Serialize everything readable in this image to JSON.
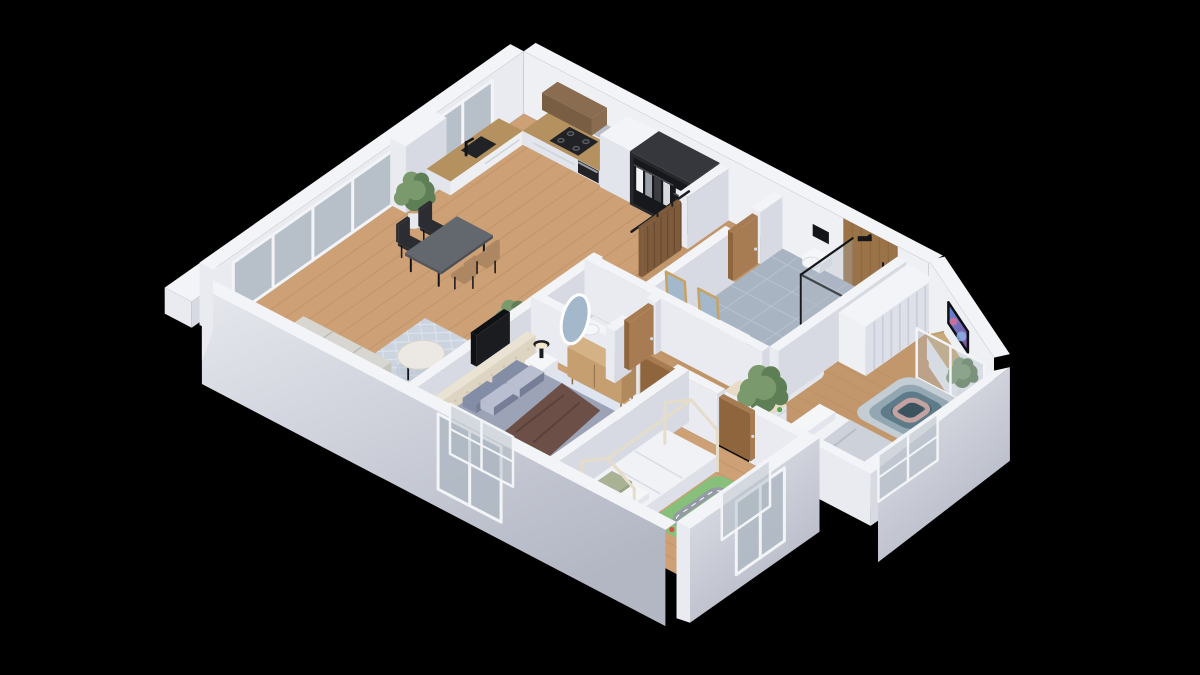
{
  "canvas": {
    "width": 1200,
    "height": 675,
    "background": "#000000"
  },
  "scene_type": "isometric-3d-apartment-floor-plan",
  "palette": {
    "bg": "#000000",
    "wall_top": "#f3f4f7",
    "wall_sw": "#e9ebf1",
    "wall_se": "#d7dae3",
    "wall_lit": "#eef0f4",
    "facade_a": "#e6e8ee",
    "facade_b": "#b3b7c4",
    "floor_wood": "#cda175",
    "floor_wood_line": "#b88d61",
    "floor_wood_dark": "#c2976b",
    "tile_bath": "#a9b4c3",
    "tile_bath_line": "#bcc6d2",
    "tile_wc": "#e8eaee",
    "glass": "#aeb8c2",
    "frame_white": "#f2f4f7",
    "rug_living": "#ccd4e0",
    "rug_living_line": "#dde3ed",
    "rug_bedroom": "#dee5f0",
    "sofa": "#d8d6d0",
    "sofa_dark": "#c6c4be",
    "marble": "#ece9e4",
    "table_dark": "#63676e",
    "chair_black": "#2b2d32",
    "chair_tan": "#ad8662",
    "counter_wood": "#b5915f",
    "cab_white": "#edeff3",
    "cab_white_face": "#e2e5ec",
    "upper_wood": "#8a6c50",
    "appliance_black": "#202226",
    "backsplash": "#b9bec8",
    "wardrobe_black": "#26282c",
    "wardrobe_inner": "#17181b",
    "door_wood": "#a87c52",
    "door_wood_dark": "#8f653d",
    "barn_wood": "#7d5b3c",
    "rail_black": "#1c1d20",
    "vanity_wood": "#b28b60",
    "white": "#f5f6f8",
    "mirror_brass": "#c6a263",
    "mirror_glass": "#a3b8ca",
    "shower_wood": "#9a7348",
    "black": "#141518",
    "tub_inner": "#dfe4ea",
    "headboard": "#eae3d3",
    "bedding_gray": "#9ca3b6",
    "bedding_side": "#b3b8c8",
    "pillow_gray": "#848da6",
    "pillow_light": "#b9bed1",
    "throw_brown": "#6c5047",
    "dresser_wood": "#c59f6f",
    "house_bed": "#e5ddca",
    "kids_bedding": "#f1f2f5",
    "pillow_sage": "#a9b295",
    "mat_green": "#87c07b",
    "mat_road": "#949ba4",
    "closet_stripe": "#c9cdd7",
    "tv_black": "#0f1013",
    "spa_r1": "#c4ccd4",
    "spa_r2": "#93a7b3",
    "spa_r3": "#5d7b88",
    "spa_r4": "#45636f",
    "spa_mauve": "#c4a2a2",
    "spa_center": "#3a535f",
    "plant_green": "#5e7f55",
    "plant_green2": "#7a9a6e",
    "pot_white": "#e8e9ec",
    "toy_colors": [
      "#d94f43",
      "#3f76c9",
      "#e8c33a",
      "#58a44f",
      "#7a52a8"
    ]
  },
  "rooms": [
    {
      "name": "living-dining-kitchen",
      "floor": "wood",
      "items": [
        "sofa",
        "area-rug",
        "coffee-table",
        "dining-table",
        "dining-chairs",
        "kitchen-counter",
        "kitchen-sink",
        "cooktop",
        "oven",
        "upper-cabinets",
        "tall-cabinet",
        "open-wardrobe",
        "floor-plants",
        "window-wall"
      ]
    },
    {
      "name": "wc",
      "floor": "tile",
      "items": [
        "toilet",
        "oval-mirror",
        "wooden-door"
      ]
    },
    {
      "name": "hallway",
      "floor": "wood",
      "items": [
        "sliding-barn-door",
        "wooden-doors"
      ]
    },
    {
      "name": "bathroom",
      "floor": "tile",
      "items": [
        "double-vanity",
        "vanity-mirrors",
        "wall-hung-toilet",
        "walk-in-shower",
        "bathtub",
        "plant"
      ]
    },
    {
      "name": "master-bedroom",
      "floor": "wood-rug",
      "items": [
        "double-bed",
        "tufted-headboard",
        "nightstand",
        "table-lamp",
        "dresser",
        "wall-tv",
        "window"
      ]
    },
    {
      "name": "kids-room",
      "floor": "wood",
      "items": [
        "house-frame-bed",
        "play-mat",
        "wooden-door"
      ]
    },
    {
      "name": "media-room",
      "floor": "wood",
      "items": [
        "wall-tv",
        "media-console",
        "sunken-spa",
        "single-bed",
        "striped-closet",
        "toy-shelf",
        "plant",
        "window"
      ]
    }
  ]
}
